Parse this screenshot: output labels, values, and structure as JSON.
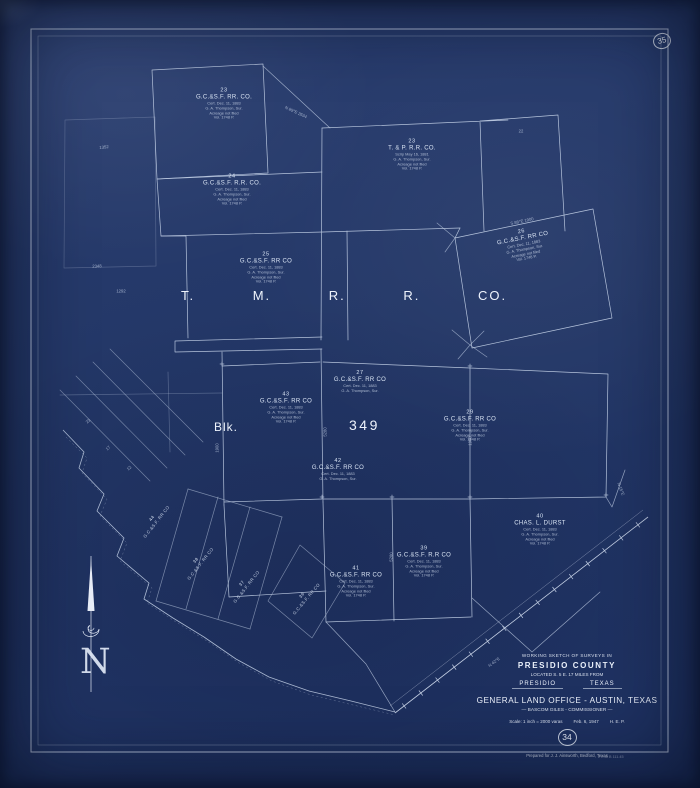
{
  "sheet": {
    "background_color": "#233767",
    "line_color": "#cfdcf0",
    "text_color": "#e6edf9",
    "corner_sheet_number": "35",
    "sheet_number": "34"
  },
  "title_block": {
    "heading": "WORKING SKETCH OF SURVEYS IN",
    "county": "PRESIDIO COUNTY",
    "located": "LOCATED S. 5 E. 17 MILES FROM",
    "town": "PRESIDIO",
    "state": "TEXAS",
    "office": "GENERAL LAND OFFICE - AUSTIN, TEXAS",
    "commissioner": "— BASCOM GILES - COMMISSIONER —",
    "scale_label": "Scale: 1 inch = 2000 varas",
    "date": "Feb. 6, 1947",
    "initials": "H. E. P.",
    "prepared_line": "Prepared for J. J. Ainsworth,  Bedford, Texas",
    "stamp_note": "2 E48 B 111.45"
  },
  "map_labels": {
    "railroad_company": "T. M. R. R. CO.",
    "block_abbrev": "Blk.",
    "block_number": "349",
    "north_letter": "N"
  },
  "parcels": [
    {
      "number": "23",
      "owner": "G.C.&S.F. RR. CO.",
      "cert": [
        "Cert. Dec. 11, 1883",
        "G. A. Thompson, Sur.",
        "Acreage not filed",
        "Vol. 1748 P."
      ],
      "x": 224,
      "y": 104,
      "rot": 0
    },
    {
      "number": "24",
      "owner": "G.C.&S.F. R.R. CO.",
      "cert": [
        "Cert. Dec. 11, 1883",
        "G. A. Thompson, Sur.",
        "Acreage not filed",
        "Vol. 1748 P."
      ],
      "x": 232,
      "y": 190,
      "rot": 0
    },
    {
      "number": "25",
      "owner": "G.C.&S.F. RR CO",
      "cert": [
        "Cert. Dec. 11, 1883",
        "G. A. Thompson, Sur.",
        "Acreage not filed",
        "Vol. 1748 P."
      ],
      "x": 266,
      "y": 268,
      "rot": 0
    },
    {
      "number": "23",
      "owner": "T. & P. R.R. CO.",
      "cert": [
        "Scrip May 16, 1881",
        "G. A. Thompson, Sur.",
        "Acreage not filed",
        "Vol. 1748 P."
      ],
      "x": 412,
      "y": 155,
      "rot": 0
    },
    {
      "number": "26",
      "owner": "G.C.&S.F. RR CO",
      "cert": [
        "Cert. Dec. 11, 1883",
        "G. A. Thompson, Sur.",
        "Acreage not filed",
        "Vol. 1748 P."
      ],
      "x": 524,
      "y": 245,
      "rot": -11
    },
    {
      "number": "27",
      "owner": "G.C.&S.F. RR CO",
      "cert": [
        "Cert. Dec. 11, 1883",
        "G. A. Thompson, Sur."
      ],
      "x": 360,
      "y": 382,
      "rot": 0
    },
    {
      "number": "43",
      "owner": "G.C.&S.F. RR CO",
      "cert": [
        "Cert. Dec. 11, 1883",
        "G. A. Thompson, Sur.",
        "Acreage not filed",
        "Vol. 1748 P."
      ],
      "x": 286,
      "y": 408,
      "rot": 0
    },
    {
      "number": "29",
      "owner": "G.C.&S.F. RR CO",
      "cert": [
        "Cert. Dec. 11, 1883",
        "G. A. Thompson, Sur.",
        "Acreage not filed",
        "Vol. 1748 P."
      ],
      "x": 470,
      "y": 426,
      "rot": 0
    },
    {
      "number": "42",
      "owner": "G.C.&S.F. RR CO",
      "cert": [
        "Cert. Dec. 11, 1883",
        "G. A. Thompson, Sur."
      ],
      "x": 338,
      "y": 470,
      "rot": 0
    },
    {
      "number": "41",
      "owner": "G.C.&S.F. RR CO",
      "cert": [
        "Cert. Dec. 11, 1883",
        "G. A. Thompson, Sur.",
        "Acreage not filed",
        "Vol. 1748 P."
      ],
      "x": 356,
      "y": 582,
      "rot": 0
    },
    {
      "number": "39",
      "owner": "G.C.&S.F. R.R CO",
      "cert": [
        "Cert. Dec. 11, 1883",
        "G. A. Thompson, Sur.",
        "Acreage not filed",
        "Vol. 1748 P."
      ],
      "x": 424,
      "y": 562,
      "rot": 0
    },
    {
      "number": "40",
      "owner": "CHAS. L. DURST",
      "cert": [
        "Cert. Dec. 11, 1883",
        "G. A. Thompson, Sur.",
        "Acreage not filed",
        "Vol. 1748 P."
      ],
      "x": 540,
      "y": 530,
      "rot": 0
    },
    {
      "number": "44",
      "owner": "G.C.&S.F. RR CO",
      "cert": [],
      "x": 154,
      "y": 520,
      "rot": -52
    },
    {
      "number": "38",
      "owner": "G.C.&S.F. RR CO",
      "cert": [],
      "x": 198,
      "y": 562,
      "rot": -52
    },
    {
      "number": "37",
      "owner": "G.C.&S.F. RR CO",
      "cert": [],
      "x": 244,
      "y": 585,
      "rot": -52
    },
    {
      "number": "36",
      "owner": "G.C.&S.F. RR CO",
      "cert": [],
      "x": 304,
      "y": 597,
      "rot": -50
    }
  ],
  "annotations": [
    {
      "text": "1352",
      "x": 104,
      "y": 147,
      "rot": -6
    },
    {
      "text": "2348",
      "x": 97,
      "y": 266,
      "rot": -2
    },
    {
      "text": "1292",
      "x": 121,
      "y": 291,
      "rot": 0
    },
    {
      "text": "N 89°E 2634",
      "x": 296,
      "y": 112,
      "rot": 25
    },
    {
      "text": "S 88°E 1900",
      "x": 522,
      "y": 221,
      "rot": -12
    },
    {
      "text": "22",
      "x": 521,
      "y": 131,
      "rot": 0
    },
    {
      "text": "1900",
      "x": 217,
      "y": 448,
      "rot": -90
    },
    {
      "text": "5280",
      "x": 325,
      "y": 432,
      "rot": -90
    },
    {
      "text": "1900",
      "x": 470,
      "y": 441,
      "rot": -90
    },
    {
      "text": "5280",
      "x": 391,
      "y": 557,
      "rot": -88
    },
    {
      "text": "N 15°E",
      "x": 621,
      "y": 489,
      "rot": 68
    },
    {
      "text": "N 42°E",
      "x": 494,
      "y": 662,
      "rot": -37
    },
    {
      "text": "23",
      "x": 88,
      "y": 421,
      "rot": -42
    },
    {
      "text": "17",
      "x": 108,
      "y": 448,
      "rot": -42
    },
    {
      "text": "12",
      "x": 129,
      "y": 468,
      "rot": -42
    }
  ]
}
